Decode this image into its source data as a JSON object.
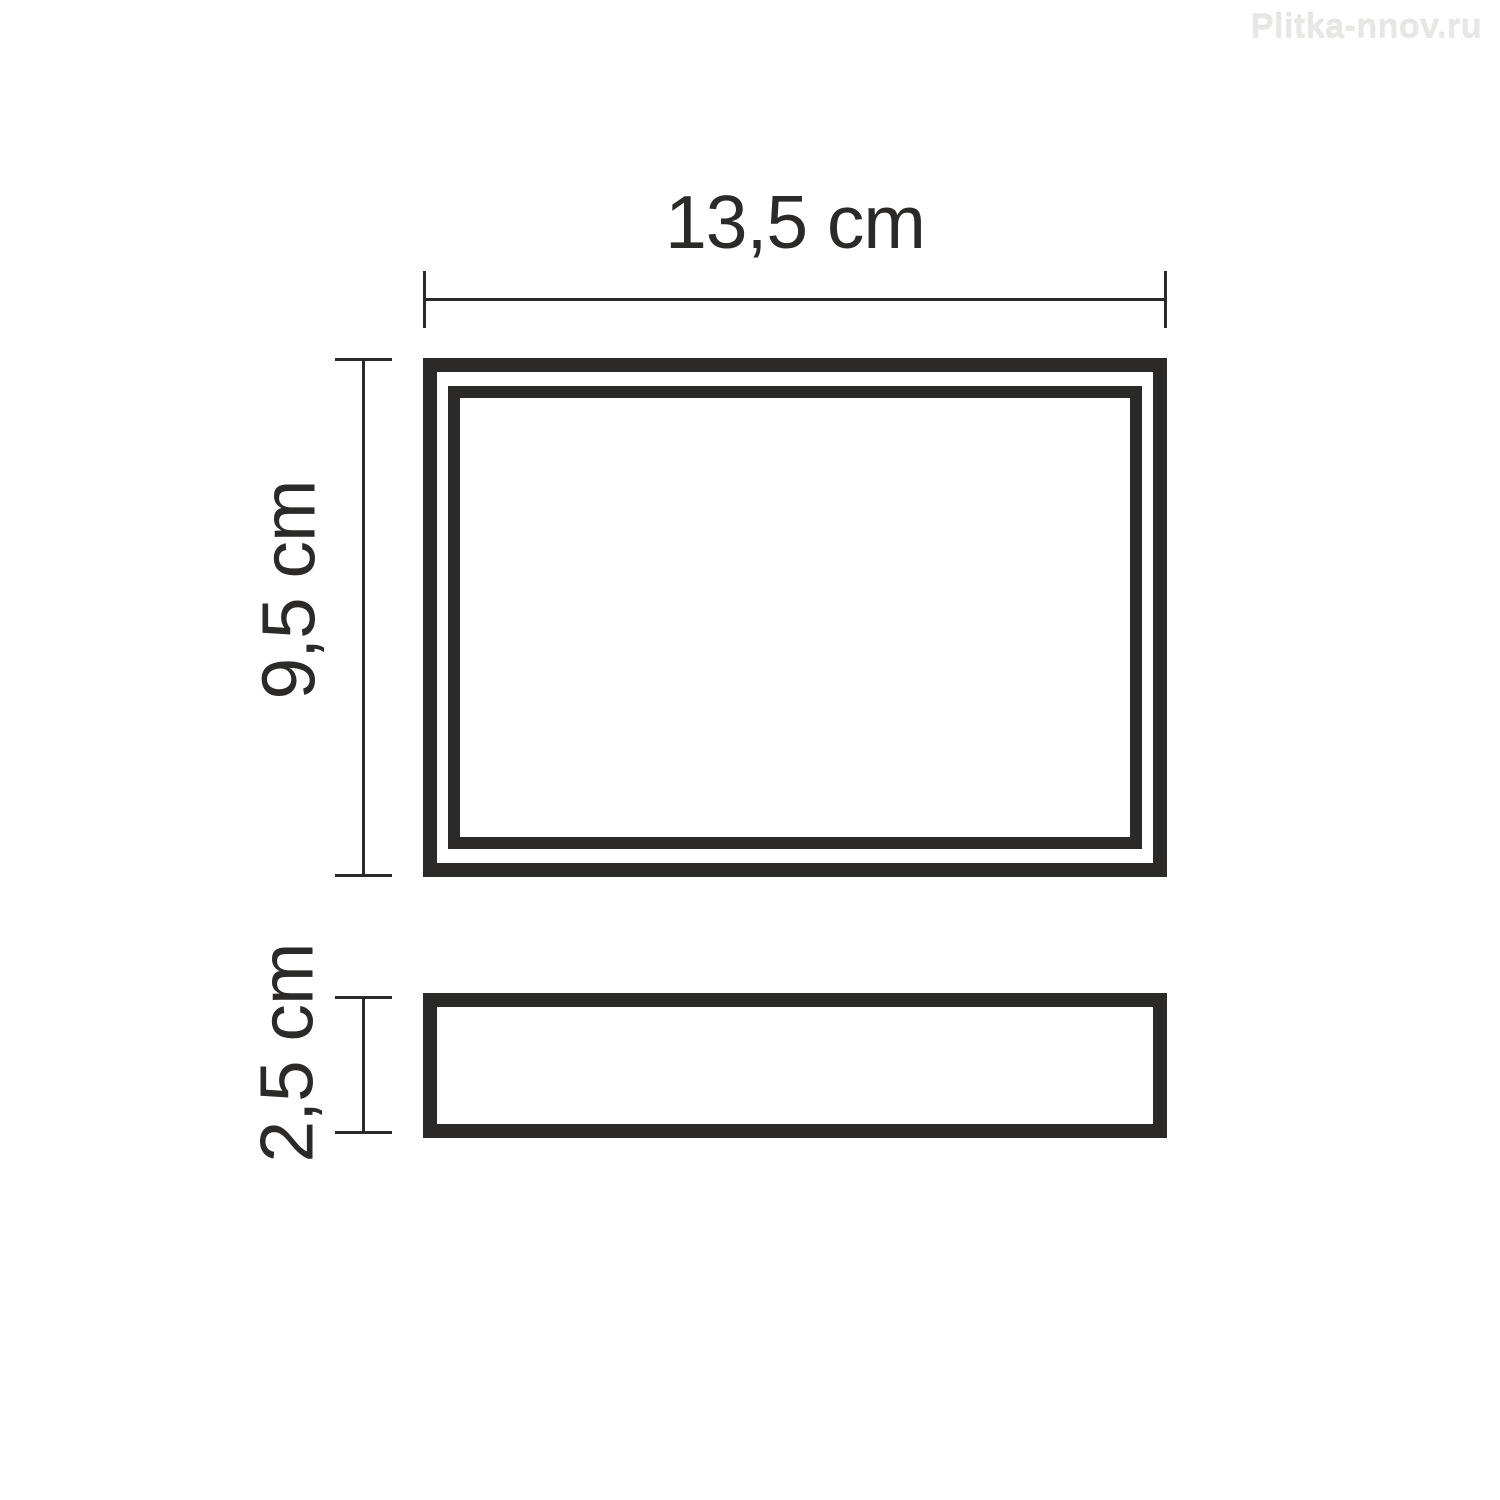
{
  "watermark": {
    "text": "Plitka-nnov.ru"
  },
  "diagram": {
    "type": "dimension-drawing",
    "views": {
      "top_view": "rectangle with inner frame (plan view)",
      "side_view": "flat bar (side profile view)"
    },
    "dimensions": {
      "width": {
        "label": "13,5 cm",
        "value_cm": 13.5
      },
      "height": {
        "label": "9,5 cm",
        "value_cm": 9.5
      },
      "depth": {
        "label": "2,5 cm",
        "value_cm": 2.5
      }
    }
  },
  "colors": {
    "line": "#2b2a29",
    "watermark": "#e7e7e5",
    "background": "#ffffff"
  }
}
